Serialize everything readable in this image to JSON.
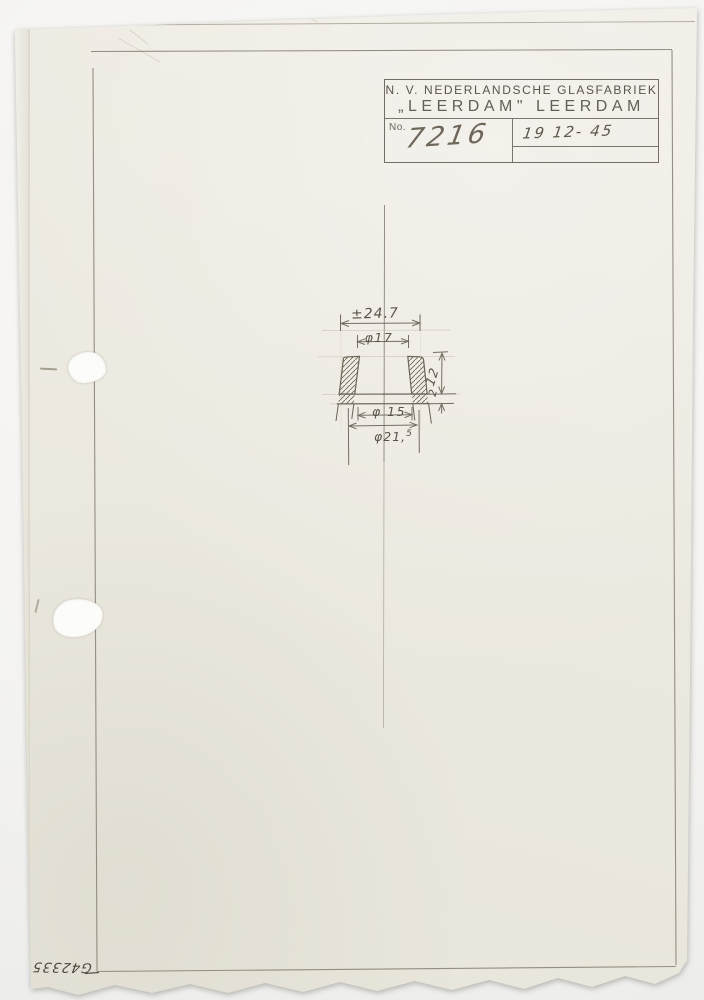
{
  "title_block": {
    "company_line1": "N. V. NEDERLANDSCHE GLASFABRIEK",
    "company_line2": "„LEERDAM\" LEERDAM",
    "no_label": "No.",
    "drawing_number": "7216",
    "date": "19 12- 45"
  },
  "dimensions": {
    "top_width": "±24.7",
    "top_inner_diameter": "φ17",
    "height": "12",
    "lip_thickness": "2",
    "bottom_inner_diameter": "φ 15",
    "bottom_outer_diameter_main": "φ21,",
    "bottom_outer_diameter_sup": "5"
  },
  "margin_note": {
    "inventory_number": "G42335"
  },
  "colors": {
    "background": "#f3f2f0",
    "paper": "#ebe8df",
    "pencil": "#7c7669",
    "stamp_ink": "#56524a"
  }
}
